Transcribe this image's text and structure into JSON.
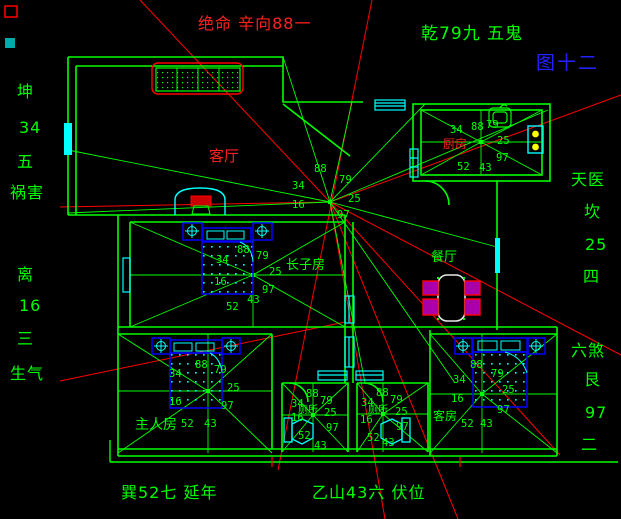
{
  "figure": {
    "number_label": "图十二"
  },
  "annotations": {
    "top_left": "绝命 辛向88一",
    "top_right": "乾79九 五鬼",
    "left_top": [
      "坤",
      "34",
      "五",
      "祸害"
    ],
    "left_bottom": [
      "离",
      "16",
      "三",
      "生气"
    ],
    "right_top": [
      "天医",
      "坎",
      "25",
      "四"
    ],
    "right_bottom": [
      "六煞",
      "艮",
      "97",
      "二"
    ],
    "bottom_left": "巽52七 延年",
    "bottom_right": "乙山43六 伏位"
  },
  "rooms": {
    "living": {
      "label": "客厅",
      "stars": [
        "88",
        "79",
        "34",
        "25",
        "16",
        "97"
      ]
    },
    "kitchen": {
      "label": "厨房",
      "stars": [
        "34",
        "88",
        "79",
        "25",
        "97",
        "43",
        "52"
      ]
    },
    "eldest": {
      "label": "长子房",
      "stars": [
        "88",
        "79",
        "34",
        "25",
        "16",
        "97",
        "43",
        "52"
      ]
    },
    "dining": {
      "label": "餐厅"
    },
    "master": {
      "label": "主人房",
      "stars": [
        "88",
        "79",
        "34",
        "25",
        "16",
        "97",
        "52",
        "43"
      ]
    },
    "bath1": {
      "label": "厕所",
      "stars": [
        "88",
        "79",
        "34",
        "25",
        "16",
        "97",
        "52",
        "43"
      ]
    },
    "bath2": {
      "label": "厕所",
      "stars": [
        "88",
        "79",
        "34",
        "25",
        "16",
        "97",
        "52",
        "43"
      ]
    },
    "guest": {
      "label": "客房",
      "stars": [
        "88",
        "79",
        "34",
        "25",
        "16",
        "97",
        "52",
        "43"
      ]
    }
  },
  "colors": {
    "background": "#000000",
    "wall_green": "#00ff00",
    "sight_red": "#ff0000",
    "fixture_cyan": "#00ffff",
    "furniture_blue": "#0000ff",
    "figure_blue": "#2222ff",
    "chair_magenta": "#ff00ff",
    "burner_yellow": "#ffff00",
    "table_white": "#e8e8e8"
  }
}
